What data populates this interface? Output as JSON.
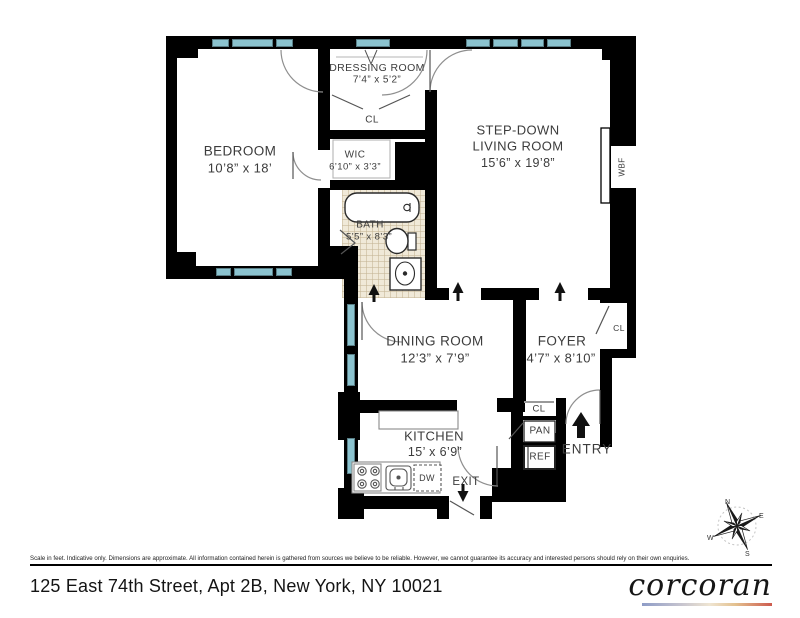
{
  "plan": {
    "rooms": {
      "dressing": {
        "name": "DRESSING ROOM",
        "dims": "7’4” x 5’2”"
      },
      "bedroom": {
        "name": "BEDROOM",
        "dims": "10’8” x 18’"
      },
      "closet_dressing": {
        "name": "CL"
      },
      "wic": {
        "name": "WIC",
        "dims": "6’10” x 3’3”"
      },
      "living": {
        "line1": "STEP-DOWN",
        "line2": "LIVING ROOM",
        "dims": "15’6” x 19’8”"
      },
      "bath": {
        "name": "BATH",
        "dims": "5’5” x 8’3”"
      },
      "dining": {
        "name": "DINING ROOM",
        "dims": "12’3” x 7’9”"
      },
      "foyer": {
        "name": "FOYER",
        "dims": "4’7” x 8’10”"
      },
      "kitchen": {
        "name": "KITCHEN",
        "dims": "15’ x 6’9”"
      },
      "closet_foyer": {
        "name": "CL"
      },
      "closet_entry": {
        "name": "CL"
      },
      "pantry": {
        "name": "PAN"
      },
      "fridge": {
        "name": "REF"
      },
      "dishwasher": {
        "name": "DW"
      },
      "fireplace": {
        "name": "WBF"
      }
    },
    "markers": {
      "entry": "ENTRY",
      "exit": "EXIT"
    },
    "compass": {
      "n": "N",
      "e": "E",
      "s": "S",
      "w": "W"
    }
  },
  "footer": {
    "disclaimer": "Scale in feet. Indicative only. Dimensions are approximate. All information contained herein is gathered from sources we believe to be reliable. However, we cannot guarantee its accuracy and interested persons should rely on their own enquiries.",
    "address": "125 East 74th Street, Apt 2B, New York, NY 10021",
    "brand": "corcoran"
  },
  "colors": {
    "wall": "#000000",
    "window": "#8bc3cf",
    "bath_tile": "#f0e9d8",
    "brand_gradient_left": "#8e9cc7",
    "brand_gradient_right": "#cd5a4e"
  }
}
